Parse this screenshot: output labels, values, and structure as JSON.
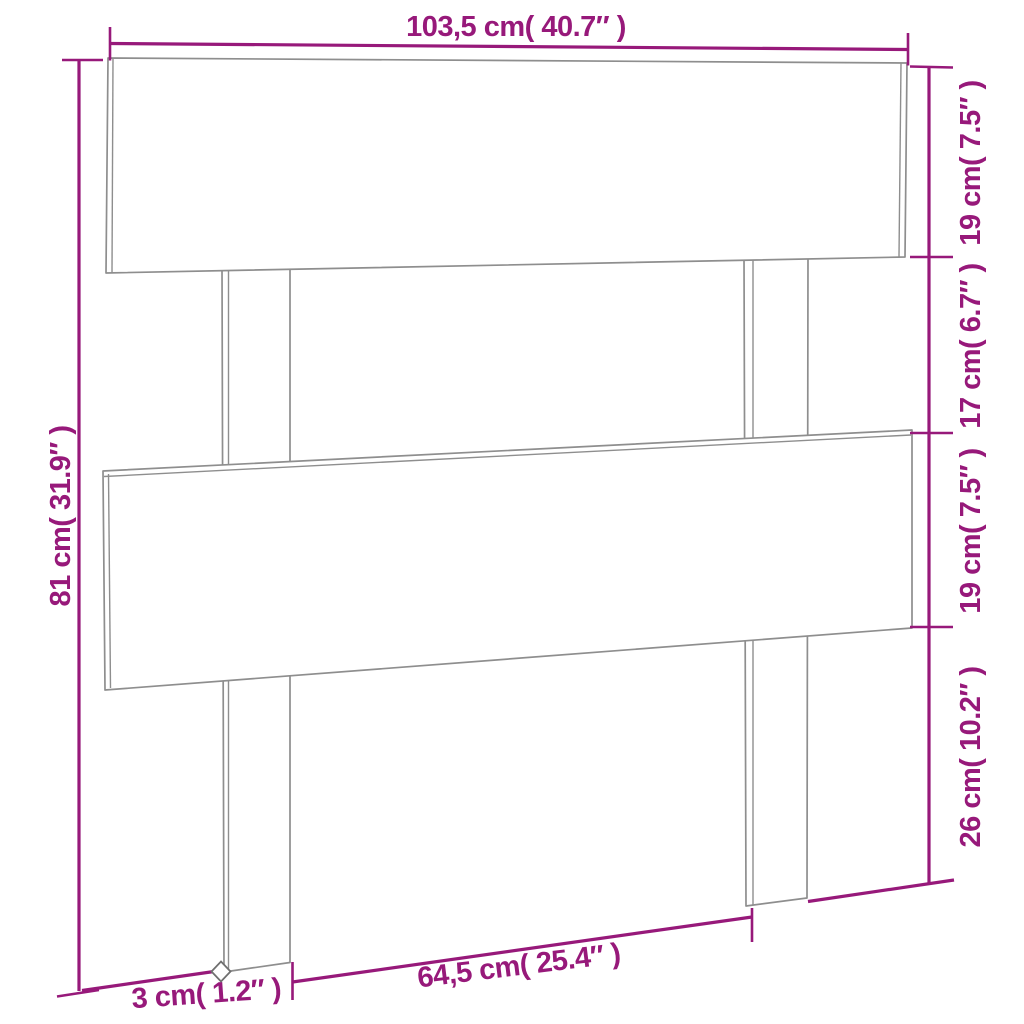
{
  "colors": {
    "accent": "#97197A",
    "drawing_lines": "#8E8E8E",
    "background": "#FFFFFF"
  },
  "dimensions": {
    "overall_width": {
      "label": "103,5 cm( 40.7″ )",
      "cm": "103,5",
      "inch": "40.7"
    },
    "overall_height": {
      "label": "81 cm( 31.9″ )",
      "cm": "81",
      "inch": "31.9"
    },
    "top_board_height": {
      "label": "19 cm( 7.5″ )",
      "cm": "19",
      "inch": "7.5"
    },
    "middle_gap_height": {
      "label": "17 cm( 6.7″ )",
      "cm": "17",
      "inch": "6.7"
    },
    "lower_board_height": {
      "label": "19 cm( 7.5″ )",
      "cm": "19",
      "inch": "7.5"
    },
    "leg_bottom_height": {
      "label": "26 cm( 10.2″ )",
      "cm": "26",
      "inch": "10.2"
    },
    "leg_depth": {
      "label": "3 cm( 1.2″ )",
      "cm": "3",
      "inch": "1.2"
    },
    "legs_span": {
      "label": "64,5 cm( 25.4″ )",
      "cm": "64,5",
      "inch": "25.4"
    }
  }
}
